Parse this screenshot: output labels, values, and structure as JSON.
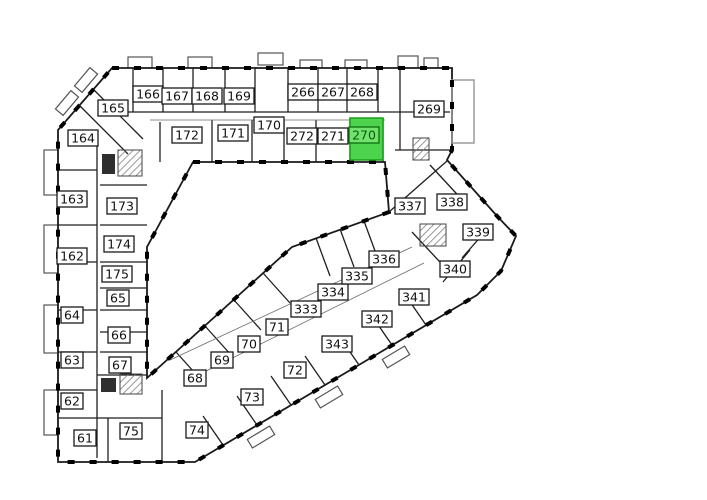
{
  "plan": {
    "name": "building-floor-plan",
    "highlighted_room": "270"
  },
  "colors": {
    "background": "#ffffff",
    "wall": "#000000",
    "label_bg": "#ffffff",
    "label_border": "#1a1a1a",
    "label_text": "#111111",
    "highlight_fill": "#4dd34d",
    "highlight_stroke": "#1b9e1b",
    "highlight_label_bg": "#71e26b",
    "highlight_label_border": "#0c6e10",
    "highlight_label_text": "#0a5a0e"
  },
  "rooms": [
    {
      "number": "166",
      "x": 148,
      "y": 94
    },
    {
      "number": "167",
      "x": 177,
      "y": 96
    },
    {
      "number": "168",
      "x": 207,
      "y": 96
    },
    {
      "number": "169",
      "x": 239,
      "y": 96
    },
    {
      "number": "266",
      "x": 303,
      "y": 92
    },
    {
      "number": "267",
      "x": 333,
      "y": 92
    },
    {
      "number": "268",
      "x": 362,
      "y": 92
    },
    {
      "number": "165",
      "x": 113,
      "y": 108
    },
    {
      "number": "172",
      "x": 187,
      "y": 135
    },
    {
      "number": "171",
      "x": 233,
      "y": 133
    },
    {
      "number": "170",
      "x": 269,
      "y": 125
    },
    {
      "number": "272",
      "x": 302,
      "y": 136
    },
    {
      "number": "271",
      "x": 333,
      "y": 136
    },
    {
      "number": "270",
      "x": 364,
      "y": 135,
      "highlight": true
    },
    {
      "number": "269",
      "x": 429,
      "y": 109
    },
    {
      "number": "164",
      "x": 83,
      "y": 138
    },
    {
      "number": "163",
      "x": 72,
      "y": 199
    },
    {
      "number": "162",
      "x": 72,
      "y": 256
    },
    {
      "number": "64",
      "x": 72,
      "y": 315
    },
    {
      "number": "63",
      "x": 72,
      "y": 360
    },
    {
      "number": "62",
      "x": 72,
      "y": 401
    },
    {
      "number": "61",
      "x": 85,
      "y": 438
    },
    {
      "number": "173",
      "x": 122,
      "y": 206
    },
    {
      "number": "174",
      "x": 119,
      "y": 244
    },
    {
      "number": "175",
      "x": 117,
      "y": 274
    },
    {
      "number": "65",
      "x": 118,
      "y": 298
    },
    {
      "number": "66",
      "x": 119,
      "y": 335
    },
    {
      "number": "67",
      "x": 120,
      "y": 365
    },
    {
      "number": "75",
      "x": 131,
      "y": 431
    },
    {
      "number": "68",
      "x": 195,
      "y": 378
    },
    {
      "number": "69",
      "x": 222,
      "y": 360
    },
    {
      "number": "70",
      "x": 249,
      "y": 344
    },
    {
      "number": "71",
      "x": 277,
      "y": 327
    },
    {
      "number": "333",
      "x": 306,
      "y": 309
    },
    {
      "number": "334",
      "x": 333,
      "y": 292
    },
    {
      "number": "335",
      "x": 357,
      "y": 276
    },
    {
      "number": "336",
      "x": 384,
      "y": 259
    },
    {
      "number": "74",
      "x": 197,
      "y": 430
    },
    {
      "number": "73",
      "x": 252,
      "y": 397
    },
    {
      "number": "72",
      "x": 295,
      "y": 370
    },
    {
      "number": "343",
      "x": 337,
      "y": 344
    },
    {
      "number": "342",
      "x": 377,
      "y": 319
    },
    {
      "number": "341",
      "x": 414,
      "y": 297
    },
    {
      "number": "337",
      "x": 410,
      "y": 206
    },
    {
      "number": "338",
      "x": 452,
      "y": 202
    },
    {
      "number": "339",
      "x": 478,
      "y": 232
    },
    {
      "number": "340",
      "x": 455,
      "y": 269
    }
  ]
}
